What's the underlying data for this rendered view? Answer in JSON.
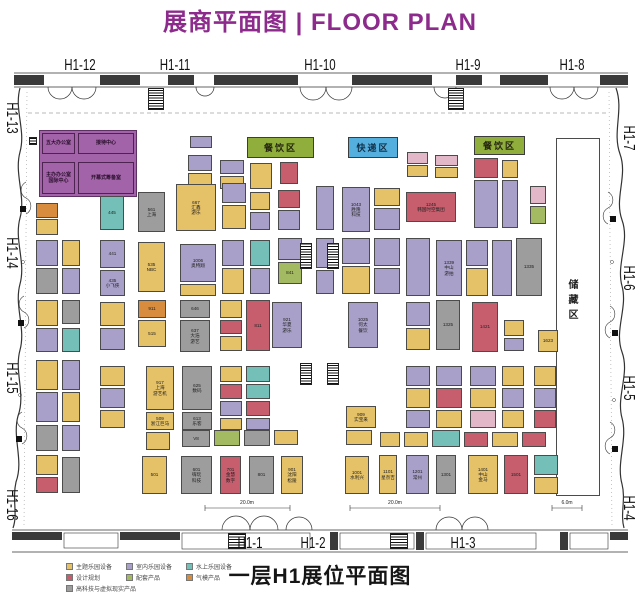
{
  "title": "展商平面图 | FLOOR PLAN",
  "title_color": "#8d2b8d",
  "bottom_title": "一层H1展位平面图",
  "palette": {
    "Y": "#e5c167",
    "P": "#a8a0c8",
    "T": "#74c0b8",
    "R": "#c75e6e",
    "G": "#a4ba62",
    "O": "#d88c3e",
    "GY": "#9d9d9d",
    "K": "#e2b8c8",
    "W": "#ffffff"
  },
  "hall_labels": [
    {
      "text": "H1-12",
      "x": 80,
      "y": 66,
      "rot": 0
    },
    {
      "text": "H1-11",
      "x": 175,
      "y": 66,
      "rot": 0
    },
    {
      "text": "H1-10",
      "x": 320,
      "y": 66,
      "rot": 0
    },
    {
      "text": "H1-9",
      "x": 468,
      "y": 66,
      "rot": 0
    },
    {
      "text": "H1-8",
      "x": 572,
      "y": 66,
      "rot": 0
    },
    {
      "text": "H1-13",
      "x": 11,
      "y": 118,
      "rot": 90
    },
    {
      "text": "H1-14",
      "x": 11,
      "y": 253,
      "rot": 90
    },
    {
      "text": "H1-15",
      "x": 11,
      "y": 378,
      "rot": 90
    },
    {
      "text": "H1-16",
      "x": 11,
      "y": 505,
      "rot": 90
    },
    {
      "text": "H1-7",
      "x": 628,
      "y": 138,
      "rot": 90
    },
    {
      "text": "H1-6",
      "x": 628,
      "y": 278,
      "rot": 90
    },
    {
      "text": "H1-5",
      "x": 628,
      "y": 388,
      "rot": 90
    },
    {
      "text": "H1-4",
      "x": 628,
      "y": 508,
      "rot": 90
    },
    {
      "text": "H1-1",
      "x": 250,
      "y": 544,
      "rot": 0
    },
    {
      "text": "H1-2",
      "x": 313,
      "y": 544,
      "rot": 0
    },
    {
      "text": "H1-3",
      "x": 463,
      "y": 544,
      "rot": 0
    }
  ],
  "zones": [
    {
      "name": "dining-area-1",
      "label": "餐饮区",
      "x": 247,
      "y": 137,
      "w": 67,
      "h": 21,
      "bg": "#8fae3c",
      "fg": "#26260f"
    },
    {
      "name": "express-area",
      "label": "快递区",
      "x": 348,
      "y": 137,
      "w": 50,
      "h": 21,
      "bg": "#54aede",
      "fg": "#10324a"
    },
    {
      "name": "dining-area-2",
      "label": "餐饮区",
      "x": 474,
      "y": 136,
      "w": 51,
      "h": 19,
      "bg": "#8fae3c",
      "fg": "#26260f"
    }
  ],
  "storage": {
    "label": "储藏区",
    "x": 556,
    "y": 138,
    "w": 44,
    "h": 358
  },
  "office": {
    "block": {
      "x": 39,
      "y": 130,
      "w": 98,
      "h": 67,
      "bg": "#a263a8"
    },
    "rooms": [
      {
        "label": "五大办公室",
        "x": 42,
        "y": 133,
        "w": 33,
        "h": 21
      },
      {
        "label": "接待中心",
        "x": 78,
        "y": 133,
        "w": 56,
        "h": 21
      },
      {
        "label": "主办办公室|国际中心",
        "x": 42,
        "y": 162,
        "w": 33,
        "h": 32
      },
      {
        "label": "开幕式筹备室",
        "x": 78,
        "y": 162,
        "w": 56,
        "h": 32
      }
    ]
  },
  "legend": {
    "items": [
      {
        "label": "主题乐园设备",
        "color": "#e5c167",
        "col": 0,
        "row": 0
      },
      {
        "label": "室内乐园设备",
        "color": "#a8a0c8",
        "col": 1,
        "row": 0
      },
      {
        "label": "水上乐园设备",
        "color": "#74c0b8",
        "col": 2,
        "row": 0
      },
      {
        "label": "设计规划",
        "color": "#c75e6e",
        "col": 0,
        "row": 1
      },
      {
        "label": "配套产品",
        "color": "#a4ba62",
        "col": 1,
        "row": 1
      },
      {
        "label": "气模产品",
        "color": "#d88c3e",
        "col": 2,
        "row": 1
      },
      {
        "label": "高科技与虚拟现实产品",
        "color": "#9d9d9d",
        "col": 0,
        "row": 2
      }
    ]
  },
  "dimensions": [
    {
      "text": "20.0m",
      "x": 247,
      "y": 500
    },
    {
      "text": "20.0m",
      "x": 395,
      "y": 500
    },
    {
      "text": "6.0m",
      "x": 567,
      "y": 500
    }
  ],
  "hatches": [
    [
      300,
      243,
      12,
      26
    ],
    [
      327,
      243,
      12,
      26
    ],
    [
      300,
      363,
      12,
      22
    ],
    [
      327,
      363,
      12,
      22
    ],
    [
      148,
      88,
      16,
      22
    ],
    [
      448,
      88,
      16,
      22
    ],
    [
      228,
      533,
      18,
      16
    ],
    [
      390,
      533,
      18,
      16
    ],
    [
      29,
      137,
      8,
      8
    ]
  ],
  "booths": [
    [
      36,
      203,
      22,
      15,
      "O",
      ""
    ],
    [
      36,
      219,
      22,
      16,
      "Y",
      ""
    ],
    [
      36,
      240,
      22,
      26,
      "P",
      ""
    ],
    [
      36,
      268,
      22,
      26,
      "GY",
      ""
    ],
    [
      36,
      300,
      22,
      26,
      "Y",
      ""
    ],
    [
      36,
      328,
      22,
      24,
      "P",
      ""
    ],
    [
      36,
      360,
      22,
      30,
      "Y",
      ""
    ],
    [
      36,
      392,
      22,
      30,
      "P",
      ""
    ],
    [
      36,
      425,
      22,
      26,
      "GY",
      ""
    ],
    [
      36,
      455,
      22,
      20,
      "Y",
      ""
    ],
    [
      36,
      477,
      22,
      16,
      "R",
      ""
    ],
    [
      62,
      240,
      18,
      26,
      "Y",
      ""
    ],
    [
      62,
      268,
      18,
      26,
      "P",
      ""
    ],
    [
      62,
      300,
      18,
      24,
      "GY",
      ""
    ],
    [
      62,
      328,
      18,
      24,
      "T",
      ""
    ],
    [
      62,
      360,
      18,
      30,
      "P",
      ""
    ],
    [
      62,
      392,
      18,
      30,
      "Y",
      ""
    ],
    [
      62,
      425,
      18,
      26,
      "P",
      ""
    ],
    [
      62,
      457,
      18,
      36,
      "GY",
      ""
    ],
    [
      190,
      136,
      22,
      12,
      "P",
      ""
    ],
    [
      188,
      155,
      24,
      16,
      "P",
      ""
    ],
    [
      188,
      173,
      24,
      16,
      "Y",
      ""
    ],
    [
      220,
      160,
      24,
      14,
      "P",
      ""
    ],
    [
      220,
      176,
      24,
      13,
      "Y",
      ""
    ],
    [
      250,
      163,
      22,
      26,
      "Y",
      ""
    ],
    [
      280,
      162,
      18,
      22,
      "R",
      ""
    ],
    [
      407,
      152,
      21,
      12,
      "K",
      ""
    ],
    [
      407,
      165,
      21,
      12,
      "Y",
      ""
    ],
    [
      435,
      155,
      23,
      11,
      "K",
      ""
    ],
    [
      435,
      167,
      23,
      11,
      "Y",
      ""
    ],
    [
      474,
      158,
      24,
      20,
      "R",
      ""
    ],
    [
      474,
      180,
      24,
      48,
      "P",
      ""
    ],
    [
      502,
      160,
      16,
      18,
      "Y",
      ""
    ],
    [
      502,
      180,
      16,
      48,
      "P",
      ""
    ],
    [
      530,
      186,
      16,
      18,
      "K",
      ""
    ],
    [
      530,
      206,
      16,
      18,
      "G",
      ""
    ],
    [
      100,
      196,
      24,
      34,
      "T",
      "445"
    ],
    [
      138,
      192,
      27,
      40,
      "GY",
      "561|上海"
    ],
    [
      176,
      184,
      40,
      47,
      "Y",
      "667|汇鑫|游乐"
    ],
    [
      222,
      183,
      24,
      20,
      "P",
      ""
    ],
    [
      222,
      205,
      24,
      24,
      "Y",
      ""
    ],
    [
      250,
      192,
      20,
      18,
      "Y",
      ""
    ],
    [
      250,
      212,
      20,
      18,
      "P",
      ""
    ],
    [
      278,
      190,
      22,
      18,
      "R",
      ""
    ],
    [
      278,
      210,
      22,
      20,
      "P",
      ""
    ],
    [
      316,
      186,
      18,
      44,
      "P",
      ""
    ],
    [
      342,
      187,
      28,
      45,
      "P",
      "1043|胜隆|科技"
    ],
    [
      374,
      188,
      26,
      18,
      "Y",
      ""
    ],
    [
      374,
      208,
      26,
      22,
      "P",
      ""
    ],
    [
      406,
      192,
      50,
      30,
      "R",
      "1245|韩国时空集团"
    ],
    [
      100,
      240,
      25,
      28,
      "P",
      "441"
    ],
    [
      100,
      270,
      25,
      26,
      "P",
      "435|小飞侠"
    ],
    [
      138,
      242,
      27,
      50,
      "Y",
      "535|NBC"
    ],
    [
      180,
      244,
      36,
      38,
      "P",
      "1006|奥特翔"
    ],
    [
      180,
      284,
      36,
      12,
      "Y",
      ""
    ],
    [
      222,
      240,
      22,
      26,
      "P",
      ""
    ],
    [
      222,
      268,
      22,
      26,
      "Y",
      ""
    ],
    [
      250,
      240,
      20,
      26,
      "T",
      ""
    ],
    [
      250,
      268,
      20,
      26,
      "P",
      ""
    ],
    [
      278,
      238,
      24,
      22,
      "P",
      ""
    ],
    [
      278,
      262,
      24,
      22,
      "G",
      "841"
    ],
    [
      316,
      238,
      18,
      30,
      "P",
      ""
    ],
    [
      316,
      270,
      18,
      24,
      "P",
      ""
    ],
    [
      342,
      238,
      28,
      26,
      "P",
      ""
    ],
    [
      342,
      266,
      28,
      28,
      "Y",
      ""
    ],
    [
      374,
      238,
      26,
      28,
      "P",
      ""
    ],
    [
      374,
      268,
      26,
      26,
      "P",
      ""
    ],
    [
      406,
      238,
      24,
      58,
      "P",
      ""
    ],
    [
      436,
      240,
      26,
      56,
      "P",
      "1339|中山|游拍"
    ],
    [
      466,
      240,
      22,
      26,
      "P",
      ""
    ],
    [
      466,
      268,
      22,
      28,
      "Y",
      ""
    ],
    [
      492,
      240,
      20,
      56,
      "P",
      ""
    ],
    [
      516,
      238,
      26,
      58,
      "GY",
      "1335"
    ],
    [
      100,
      302,
      25,
      24,
      "Y",
      ""
    ],
    [
      100,
      328,
      25,
      22,
      "P",
      ""
    ],
    [
      138,
      300,
      28,
      18,
      "O",
      "911"
    ],
    [
      138,
      320,
      28,
      27,
      "Y",
      "515"
    ],
    [
      180,
      300,
      30,
      18,
      "GY",
      "646"
    ],
    [
      180,
      320,
      30,
      32,
      "GY",
      "637|大浩|游艺"
    ],
    [
      220,
      300,
      22,
      18,
      "Y",
      ""
    ],
    [
      220,
      320,
      22,
      14,
      "R",
      ""
    ],
    [
      220,
      336,
      22,
      15,
      "Y",
      ""
    ],
    [
      246,
      300,
      24,
      51,
      "R",
      "811"
    ],
    [
      272,
      302,
      30,
      46,
      "P",
      "921|华夏|游乐"
    ],
    [
      348,
      302,
      30,
      46,
      "P",
      "1025|何太|餐饮"
    ],
    [
      406,
      302,
      24,
      24,
      "P",
      ""
    ],
    [
      406,
      328,
      24,
      22,
      "Y",
      ""
    ],
    [
      436,
      300,
      24,
      50,
      "GY",
      "1325"
    ],
    [
      472,
      302,
      26,
      50,
      "R",
      "1421"
    ],
    [
      504,
      320,
      20,
      16,
      "Y",
      ""
    ],
    [
      504,
      338,
      20,
      13,
      "P",
      ""
    ],
    [
      538,
      330,
      20,
      22,
      "Y",
      "1623"
    ],
    [
      100,
      366,
      25,
      20,
      "Y",
      ""
    ],
    [
      100,
      388,
      25,
      20,
      "P",
      ""
    ],
    [
      100,
      410,
      25,
      18,
      "Y",
      ""
    ],
    [
      146,
      366,
      28,
      44,
      "Y",
      "917|上海|游艺机"
    ],
    [
      146,
      412,
      28,
      18,
      "Y",
      "509|浙江巨马"
    ],
    [
      182,
      366,
      30,
      44,
      "GY",
      "625|数码"
    ],
    [
      182,
      412,
      30,
      18,
      "GY",
      "613|乐客"
    ],
    [
      220,
      366,
      22,
      16,
      "Y",
      ""
    ],
    [
      220,
      384,
      22,
      15,
      "R",
      ""
    ],
    [
      220,
      401,
      22,
      15,
      "P",
      ""
    ],
    [
      220,
      418,
      22,
      12,
      "Y",
      ""
    ],
    [
      246,
      366,
      24,
      16,
      "T",
      ""
    ],
    [
      246,
      384,
      24,
      15,
      "T",
      ""
    ],
    [
      246,
      401,
      24,
      15,
      "R",
      ""
    ],
    [
      246,
      418,
      24,
      12,
      "P",
      ""
    ],
    [
      346,
      406,
      30,
      22,
      "Y",
      "909|实宝来"
    ],
    [
      406,
      366,
      24,
      20,
      "P",
      ""
    ],
    [
      406,
      388,
      24,
      20,
      "Y",
      ""
    ],
    [
      406,
      410,
      24,
      18,
      "P",
      ""
    ],
    [
      436,
      366,
      26,
      20,
      "P",
      ""
    ],
    [
      436,
      388,
      26,
      20,
      "R",
      ""
    ],
    [
      436,
      410,
      26,
      18,
      "Y",
      ""
    ],
    [
      470,
      366,
      26,
      20,
      "P",
      ""
    ],
    [
      470,
      388,
      26,
      20,
      "Y",
      ""
    ],
    [
      470,
      410,
      26,
      18,
      "K",
      ""
    ],
    [
      502,
      366,
      22,
      20,
      "Y",
      ""
    ],
    [
      502,
      388,
      22,
      20,
      "P",
      ""
    ],
    [
      502,
      410,
      22,
      18,
      "Y",
      ""
    ],
    [
      534,
      366,
      22,
      20,
      "Y",
      ""
    ],
    [
      534,
      388,
      22,
      20,
      "P",
      ""
    ],
    [
      534,
      410,
      22,
      18,
      "R",
      ""
    ],
    [
      146,
      432,
      24,
      18,
      "Y",
      ""
    ],
    [
      182,
      430,
      28,
      17,
      "GY",
      "V8"
    ],
    [
      214,
      430,
      26,
      16,
      "G",
      ""
    ],
    [
      244,
      430,
      26,
      16,
      "GY",
      ""
    ],
    [
      274,
      430,
      24,
      15,
      "Y",
      ""
    ],
    [
      346,
      430,
      26,
      15,
      "Y",
      ""
    ],
    [
      380,
      432,
      20,
      15,
      "Y",
      ""
    ],
    [
      404,
      432,
      24,
      15,
      "Y",
      ""
    ],
    [
      432,
      430,
      28,
      17,
      "T",
      ""
    ],
    [
      464,
      432,
      24,
      15,
      "R",
      ""
    ],
    [
      492,
      432,
      26,
      15,
      "Y",
      ""
    ],
    [
      522,
      432,
      24,
      15,
      "R",
      ""
    ],
    [
      142,
      456,
      25,
      38,
      "Y",
      "501"
    ],
    [
      181,
      456,
      31,
      38,
      "GY",
      "601|嗨玩|科技"
    ],
    [
      220,
      456,
      21,
      38,
      "R",
      "701|金慧|数字"
    ],
    [
      249,
      456,
      25,
      38,
      "GY",
      "801"
    ],
    [
      281,
      456,
      22,
      38,
      "Y",
      "901|沈阳|松陵"
    ],
    [
      345,
      456,
      24,
      38,
      "Y",
      "1001|水利兴"
    ],
    [
      379,
      455,
      18,
      39,
      "Y",
      "1101|星奈吉"
    ],
    [
      406,
      455,
      23,
      39,
      "P",
      "1201|常州"
    ],
    [
      436,
      455,
      20,
      39,
      "GY",
      "1301"
    ],
    [
      468,
      455,
      30,
      39,
      "Y",
      "1401|中山|金马"
    ],
    [
      504,
      455,
      24,
      39,
      "R",
      "1501"
    ],
    [
      534,
      455,
      24,
      20,
      "T",
      ""
    ],
    [
      534,
      477,
      24,
      17,
      "Y",
      ""
    ]
  ]
}
